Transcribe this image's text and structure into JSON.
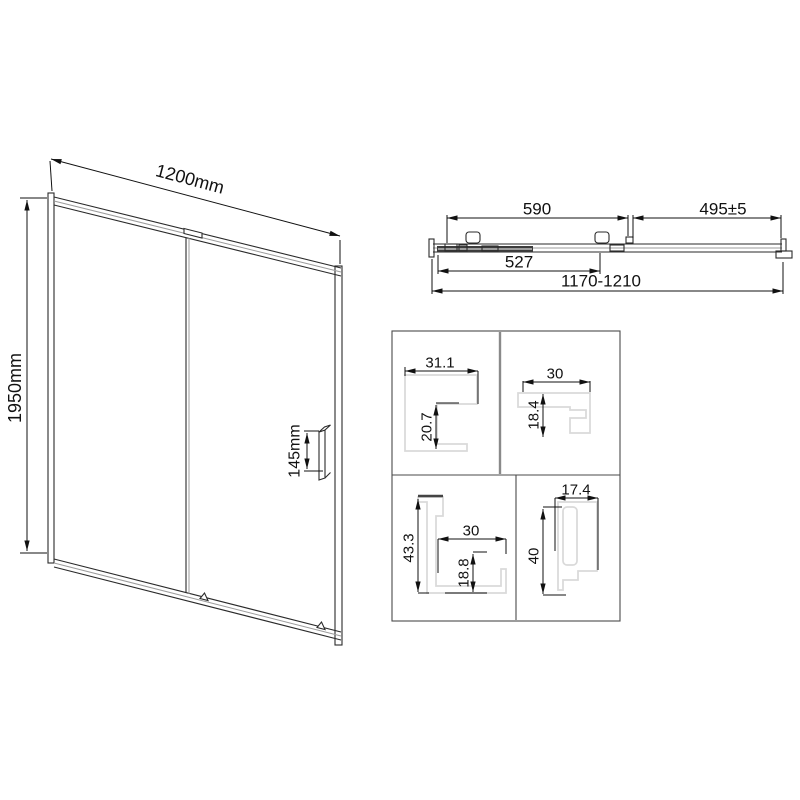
{
  "drawing": {
    "front_view": {
      "width_label": "1200mm",
      "height_label": "1950mm",
      "handle_label": "145mm"
    },
    "top_view": {
      "glass_width_label": "590",
      "adjust_label": "495±5",
      "panel_width_label": "527",
      "range_label": "1170-1210"
    },
    "profiles": {
      "p1": {
        "width": "31.1",
        "height": "20.7"
      },
      "p2": {
        "width": "30",
        "height": "18.4"
      },
      "p3": {
        "height": "43.3",
        "width": "30",
        "inner_height": "18.8"
      },
      "p4": {
        "width": "17.4",
        "height": "40"
      }
    },
    "colors": {
      "line": "#2a2a2a",
      "dimension": "#111111",
      "secondary": "#9b9b9b",
      "profile_outline": "#d9d9d9",
      "background": "#ffffff"
    }
  }
}
